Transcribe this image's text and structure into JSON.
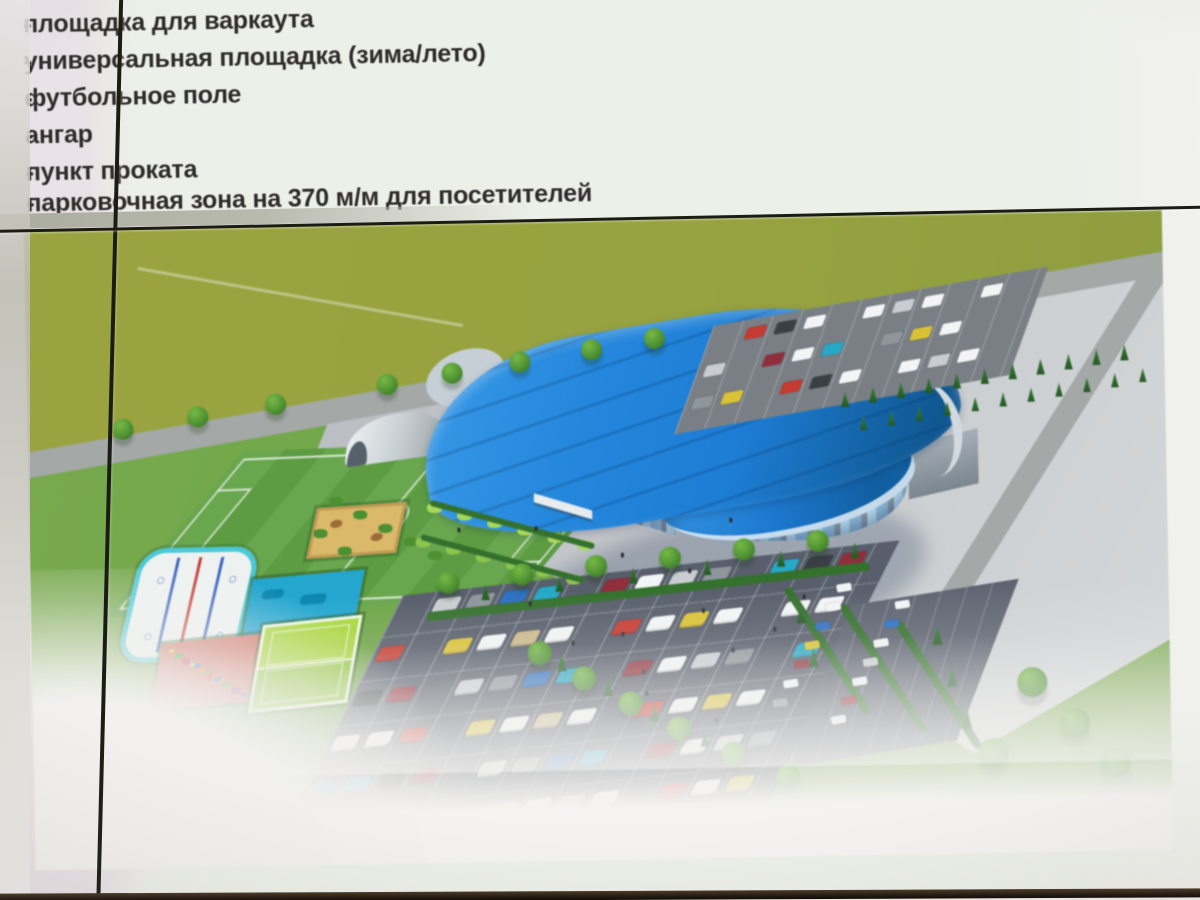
{
  "slide": {
    "bullet_marker": "-",
    "bullets": [
      "площадка для варкаута",
      "универсальная площадка (зима/лето)",
      "футбольное поле",
      "ангар",
      "пункт проката",
      "парковочная зона на 370 м/м для посетителей"
    ]
  },
  "rendering": {
    "features": [
      "arena-with-blue-roof",
      "football-field",
      "ice-rink",
      "sand-court",
      "workout-area",
      "playground",
      "tennis-courts",
      "hangar",
      "visitor-parking",
      "trees",
      "plaza"
    ]
  },
  "photo": {
    "colors": {
      "slide_bg_left": "#e9e2e6",
      "slide_bg_right": "#edefe9",
      "text": "#2e2c2b",
      "far_field": "#97a243",
      "grass": "#74a44c",
      "road": "#a4a8a7",
      "plaza": "#c2c5c9",
      "asphalt": "#585e6b",
      "arena_roof": "#1f7cd0",
      "arena_roof_light": "#3b9ae4",
      "arena_roof_dark": "#11578f",
      "glass": "#bfe0f0",
      "pillar": "#8a95a0",
      "rink": "#edf2f0",
      "rink_border": "#4fc8d6",
      "rink_line_red": "#c23b35",
      "rink_line_blue": "#3a62b8",
      "sand": "#d9b96c",
      "workout": "#27a5cd",
      "playground": "#cd7468",
      "tennis": "#a9d63f",
      "tennis_dark": "#8cc436",
      "hedge": "#35702e",
      "tree": "#4e8f33",
      "conifer": "#2c6a2e",
      "hangar": "#ccd3d6",
      "seam": "#1b1d15",
      "bezel": "#221910",
      "car_palette": [
        "#f2f4f5",
        "#f2f4f5",
        "#c9cdd1",
        "#f2f4f5",
        "#8e959b",
        "#c23b32",
        "#2f6fbe",
        "#f2f4f5",
        "#29a7c4",
        "#d9c23a",
        "#3a3f45",
        "#f2f4f5",
        "#8e2f3c",
        "#cbb98e"
      ]
    }
  }
}
